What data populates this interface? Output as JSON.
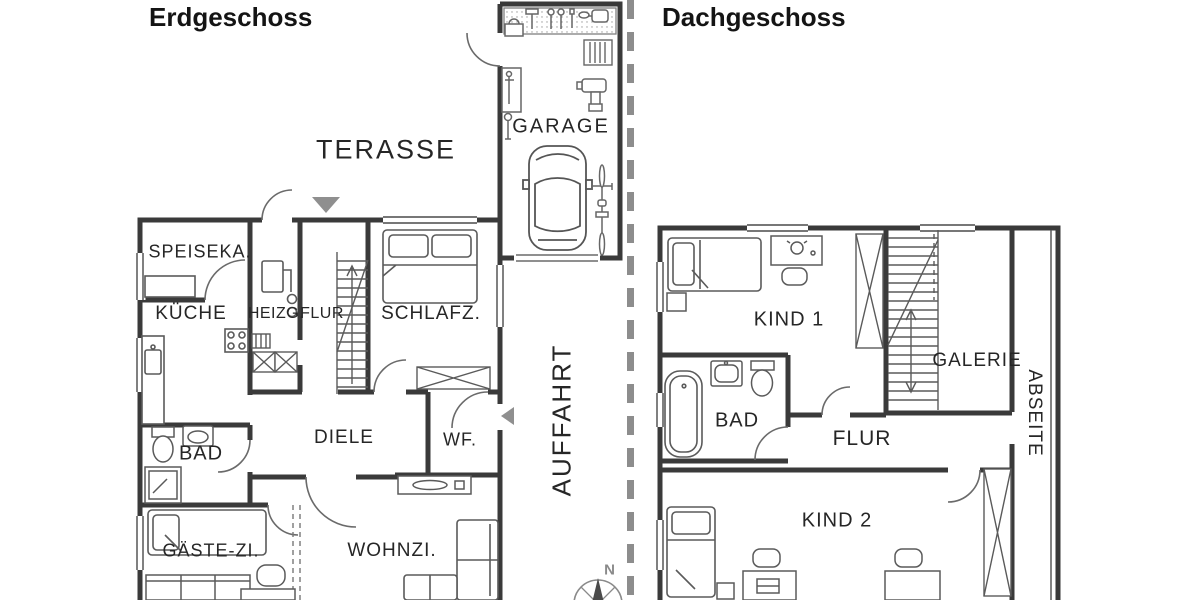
{
  "titles": {
    "left": "Erdgeschoss",
    "right": "Dachgeschoss"
  },
  "ground_floor": {
    "terrace": "TERASSE",
    "garage": "GARAGE",
    "driveway": "AUFFAHRT",
    "pantry": "SPEISEKA.",
    "kitchen": "KÜCHE",
    "heating": "HEIZG.",
    "hallway": "FLUR",
    "bedroom": "SCHLAFZ.",
    "hall": "DIELE",
    "utility": "WF.",
    "bath": "BAD",
    "guest_room": "GÄSTE-ZI.",
    "living_room": "WOHNZI."
  },
  "attic_floor": {
    "child_room_1": "KIND 1",
    "gallery": "GALERIE",
    "eaves": "ABSEITE",
    "bath": "BAD",
    "hallway": "FLUR",
    "child_room_2": "KIND 2"
  },
  "compass": {
    "north": "N"
  },
  "colors": {
    "wall": "#3a3a3a",
    "furniture": "#5a5a5a",
    "light_gray": "#8f8f8f",
    "label_text": "#262626",
    "divider": "#8d8d8d",
    "background": "#ffffff"
  }
}
